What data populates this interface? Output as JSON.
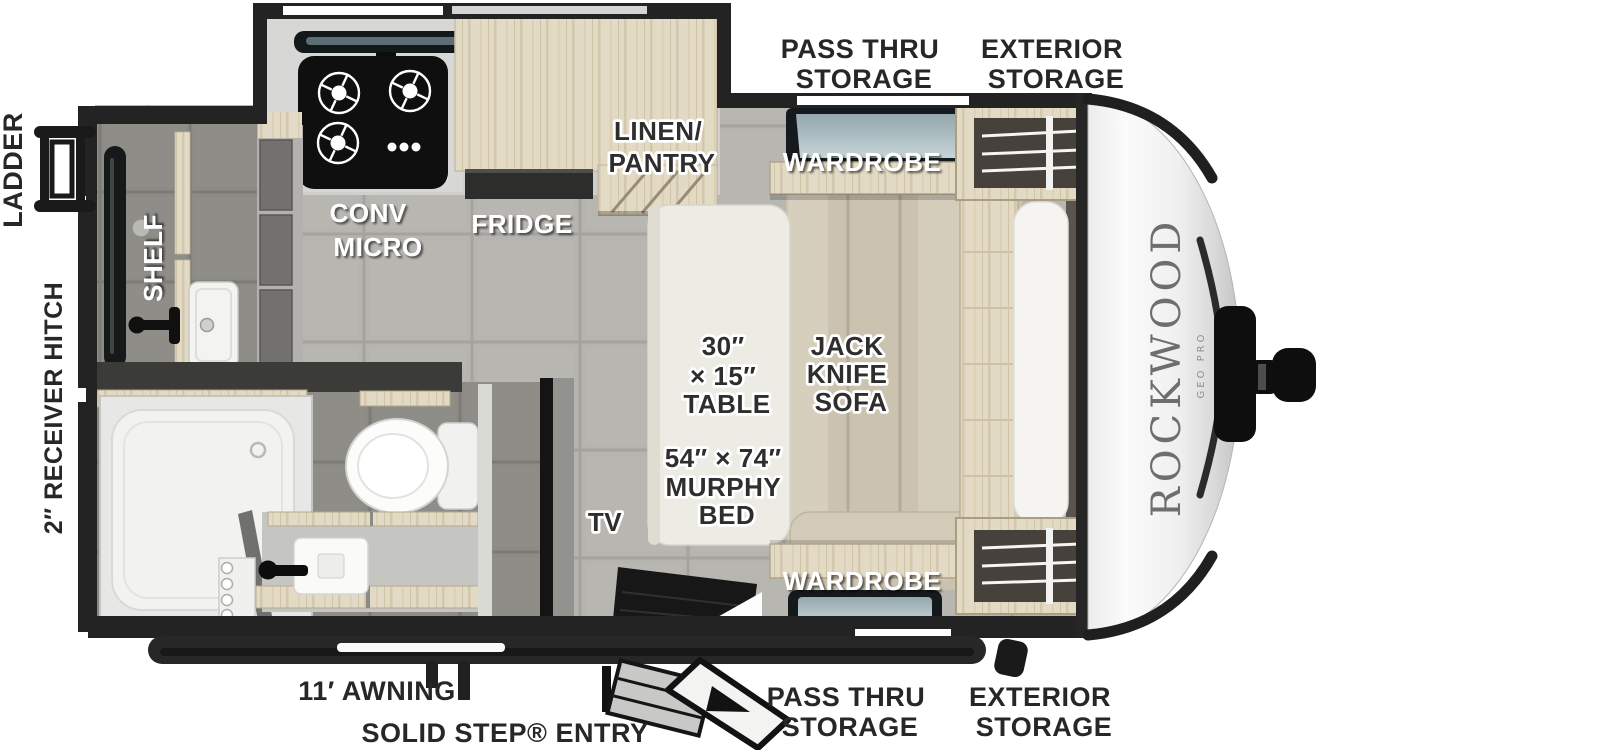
{
  "title": "Rockwood travel trailer floorplan",
  "brand": {
    "name": "ROCKWOOD",
    "sub": "GEO PRO"
  },
  "colors": {
    "wall": "#232323",
    "floor": "#b6b4af",
    "bath_floor": "#8c8b86",
    "wood": "#e3dac6",
    "upholstery": "#ccc3b1",
    "label_dark": "#272727",
    "label_white": "#ffffff"
  },
  "exterior": {
    "ladder": "LADDER",
    "receiver_hitch": "2″ RECEIVER HITCH",
    "awning": "11′ AWNING",
    "entry": "SOLID STEP® ENTRY",
    "top": {
      "pass_thru": [
        "PASS THRU",
        "STORAGE"
      ],
      "exterior_storage": [
        "EXTERIOR",
        "STORAGE"
      ]
    },
    "bottom": {
      "pass_thru": [
        "PASS THRU",
        "STORAGE"
      ],
      "exterior_storage": [
        "EXTERIOR",
        "STORAGE"
      ]
    }
  },
  "interior": {
    "shelf": "SHELF",
    "conv_micro": [
      "CONV",
      "MICRO"
    ],
    "fridge": "FRIDGE",
    "linen_pantry": [
      "LINEN/",
      "PANTRY"
    ],
    "wardrobe_top": "WARDROBE",
    "wardrobe_bottom": "WARDROBE",
    "table": [
      "30″",
      "× 15″",
      "TABLE"
    ],
    "sofa": [
      "JACK",
      "KNIFE",
      "SOFA"
    ],
    "murphy_bed": [
      "54″ × 74″",
      "MURPHY",
      "BED"
    ],
    "tv": "TV"
  }
}
